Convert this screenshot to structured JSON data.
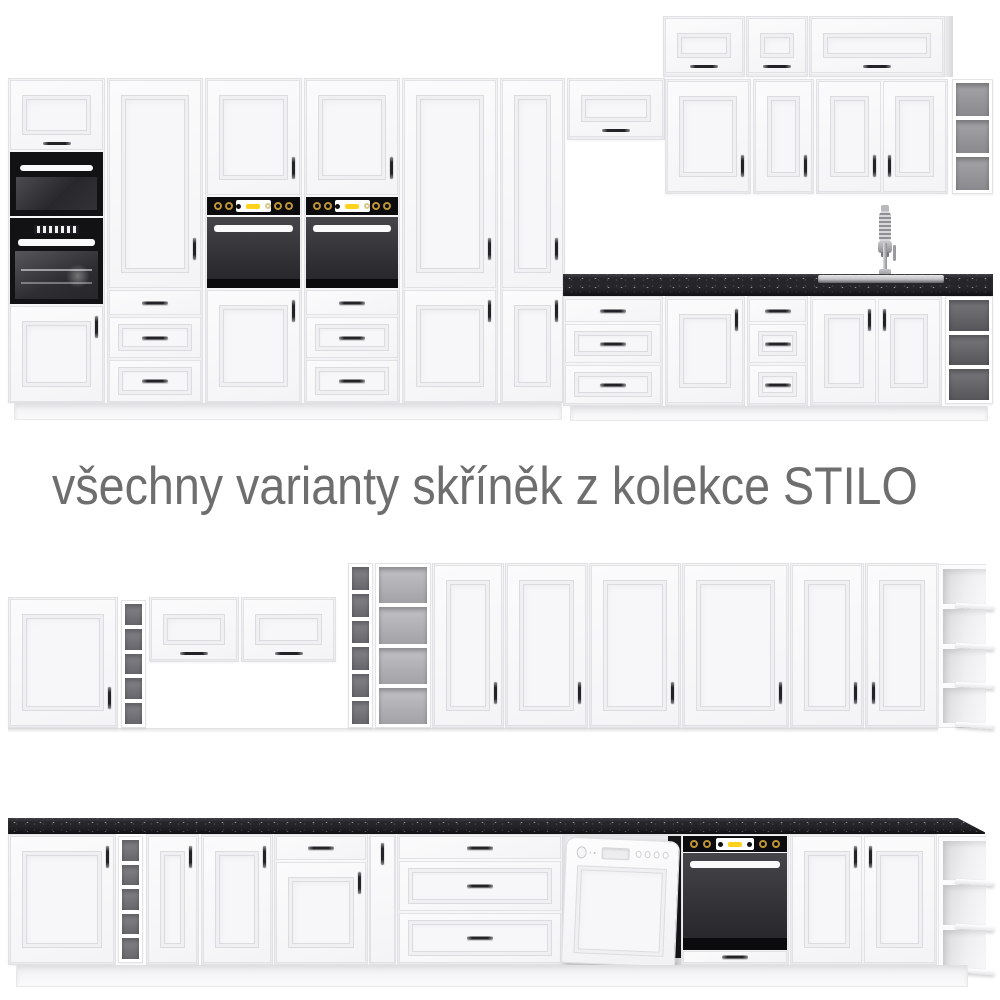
{
  "title": {
    "text": "všechny varianty skříněk z kolekce STILO"
  },
  "collection_name": "STILO",
  "colors": {
    "background": "#ffffff",
    "cabinet_front": "#f4f4f6",
    "cabinet_frame": "#e2e2e6",
    "countertop": "#26262a",
    "appliance_black": "#121215",
    "accent_yellow": "#ffd21e",
    "knob_gold": "#bf9433",
    "title_text": "#6e6e6e",
    "shelf_interior": "#85858a"
  },
  "rows": [
    {
      "name": "top kitchen set",
      "units": [
        "tall cabinet with lift-up door, microwave and oven",
        "tall larder cabinet with three drawers",
        "tall cabinet with built-in oven and two doors",
        "tall cabinet with built-in oven and three drawers",
        "tall two-door larder cabinet",
        "narrow tall two-door larder cabinet",
        "wall cabinet with lift-up door",
        "three top wall cabinets with lift-up doors",
        "four wall door cabinets",
        "open wall shelf column",
        "black worktop with sink and tall faucet",
        "base three-drawer cabinet",
        "base door cabinet",
        "base three-drawer cabinet",
        "two-door sink base cabinet",
        "open base shelf column"
      ]
    },
    {
      "name": "middle kitchen set",
      "units": [
        "wall door cabinet",
        "narrow open shelf column with five compartments",
        "two wall cabinets with lift-up doors",
        "narrow open shelf column with six compartments",
        "open shelf cabinet with four compartments",
        "six tall door cabinets",
        "open end shelf unit with four shelves"
      ]
    },
    {
      "name": "bottom kitchen set",
      "units": [
        "black worktop with angled end",
        "base door cabinet",
        "narrow open shelf column with five compartments",
        "two base door cabinets",
        "base cabinet with drawer and door",
        "narrow base door cabinet",
        "base three-drawer cabinet",
        "dishwasher with furniture front",
        "base cabinet with built-in oven",
        "two-door base cabinet",
        "open end shelf unit with three shelves"
      ]
    }
  ]
}
